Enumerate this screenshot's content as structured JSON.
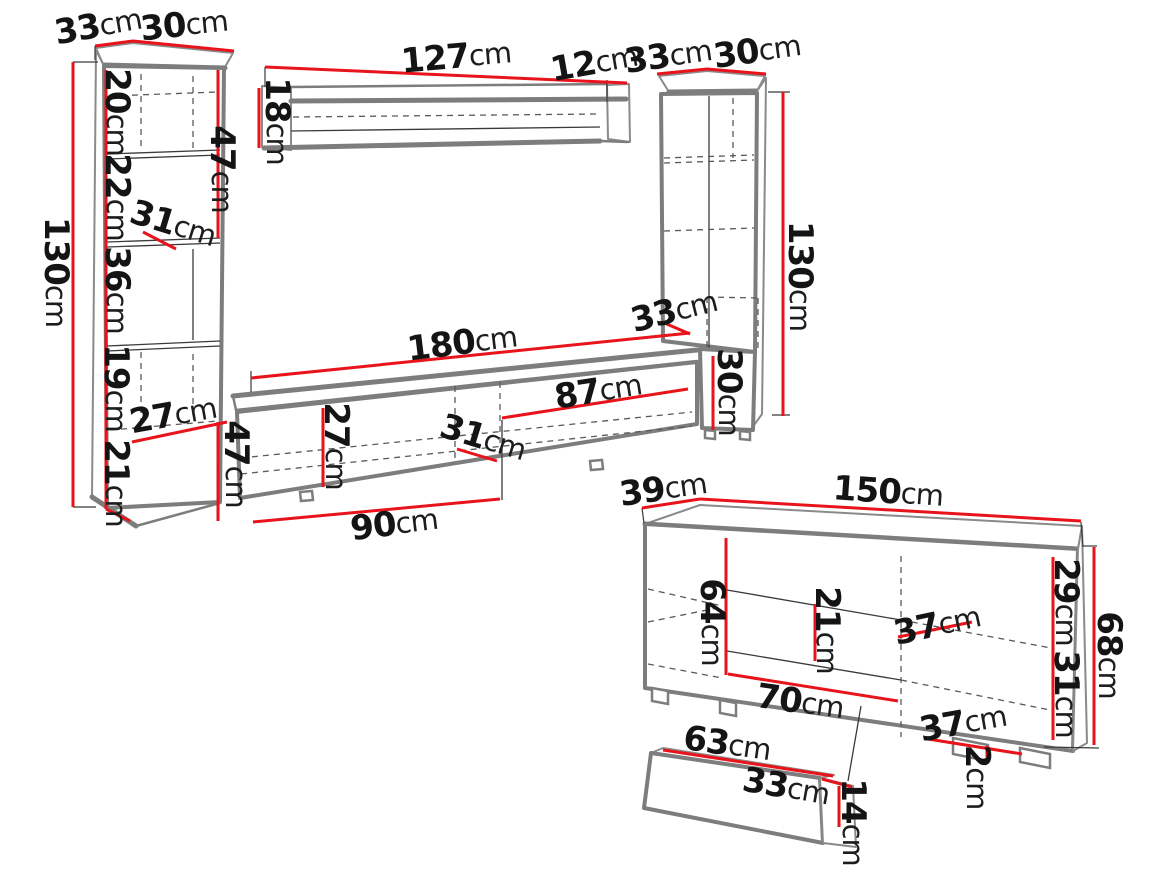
{
  "diagram": {
    "description": "Furniture wall-unit dimension drawing",
    "unit": "cm",
    "colors": {
      "background": "#ffffff",
      "outline": "#7d7d7d",
      "hidden_line": "#5a5a5a",
      "dimension_line": "#e8131b",
      "label_text": "#141414"
    }
  },
  "pieces": [
    {
      "id": "left-cabinet",
      "labels": [
        {
          "value": "33",
          "unit": "cm",
          "x": 98,
          "y": 26,
          "rot": -10
        },
        {
          "value": "30",
          "unit": "cm",
          "x": 184,
          "y": 25,
          "rot": -6
        },
        {
          "value": "130",
          "unit": "cm",
          "x": 56,
          "y": 272,
          "rot": 90
        },
        {
          "value": "20",
          "unit": "cm",
          "x": 117,
          "y": 112,
          "rot": 90
        },
        {
          "value": "22",
          "unit": "cm",
          "x": 117,
          "y": 197,
          "rot": 90
        },
        {
          "value": "31",
          "unit": "cm",
          "x": 173,
          "y": 224,
          "rot": 17
        },
        {
          "value": "36",
          "unit": "cm",
          "x": 117,
          "y": 290,
          "rot": 90
        },
        {
          "value": "19",
          "unit": "cm",
          "x": 116,
          "y": 388,
          "rot": 90
        },
        {
          "value": "27",
          "unit": "cm",
          "x": 173,
          "y": 415,
          "rot": -10
        },
        {
          "value": "21",
          "unit": "cm",
          "x": 116,
          "y": 483,
          "rot": 90
        },
        {
          "value": "47",
          "unit": "cm",
          "x": 222,
          "y": 169,
          "rot": 90
        }
      ]
    },
    {
      "id": "wall-shelf",
      "labels": [
        {
          "value": "127",
          "unit": "cm",
          "x": 456,
          "y": 57,
          "rot": -5
        },
        {
          "value": "12",
          "unit": "cm",
          "x": 594,
          "y": 63,
          "rot": -10
        },
        {
          "value": "18",
          "unit": "cm",
          "x": 277,
          "y": 121,
          "rot": 90
        }
      ]
    },
    {
      "id": "right-cabinet",
      "labels": [
        {
          "value": "33",
          "unit": "cm",
          "x": 668,
          "y": 56,
          "rot": -8
        },
        {
          "value": "30",
          "unit": "cm",
          "x": 757,
          "y": 51,
          "rot": -8
        },
        {
          "value": "130",
          "unit": "cm",
          "x": 800,
          "y": 276,
          "rot": 90
        },
        {
          "value": "33",
          "unit": "cm",
          "x": 674,
          "y": 311,
          "rot": -14
        },
        {
          "value": "30",
          "unit": "cm",
          "x": 729,
          "y": 392,
          "rot": 90
        }
      ]
    },
    {
      "id": "tv-stand",
      "labels": [
        {
          "value": "180",
          "unit": "cm",
          "x": 462,
          "y": 343,
          "rot": -7
        },
        {
          "value": "87",
          "unit": "cm",
          "x": 598,
          "y": 391,
          "rot": -9
        },
        {
          "value": "27",
          "unit": "cm",
          "x": 336,
          "y": 446,
          "rot": 90
        },
        {
          "value": "31",
          "unit": "cm",
          "x": 483,
          "y": 438,
          "rot": 17
        },
        {
          "value": "47",
          "unit": "cm",
          "x": 236,
          "y": 464,
          "rot": 90
        },
        {
          "value": "90",
          "unit": "cm",
          "x": 394,
          "y": 524,
          "rot": -7
        }
      ]
    },
    {
      "id": "sideboard",
      "labels": [
        {
          "value": "39",
          "unit": "cm",
          "x": 663,
          "y": 489,
          "rot": -8
        },
        {
          "value": "150",
          "unit": "cm",
          "x": 888,
          "y": 492,
          "rot": 4
        },
        {
          "value": "64",
          "unit": "cm",
          "x": 712,
          "y": 622,
          "rot": 90
        },
        {
          "value": "21",
          "unit": "cm",
          "x": 827,
          "y": 630,
          "rot": 90
        },
        {
          "value": "37",
          "unit": "cm",
          "x": 937,
          "y": 625,
          "rot": -12
        },
        {
          "value": "29",
          "unit": "cm",
          "x": 1066,
          "y": 602,
          "rot": 90
        },
        {
          "value": "31",
          "unit": "cm",
          "x": 1066,
          "y": 694,
          "rot": 90
        },
        {
          "value": "68",
          "unit": "cm",
          "x": 1109,
          "y": 655,
          "rot": 90
        },
        {
          "value": "70",
          "unit": "cm",
          "x": 800,
          "y": 702,
          "rot": 8
        },
        {
          "value": "37",
          "unit": "cm",
          "x": 963,
          "y": 723,
          "rot": -10
        },
        {
          "value": "2",
          "unit": "cm",
          "x": 977,
          "y": 777,
          "rot": 90
        }
      ]
    },
    {
      "id": "drawer",
      "labels": [
        {
          "value": "63",
          "unit": "cm",
          "x": 727,
          "y": 744,
          "rot": 8
        },
        {
          "value": "33",
          "unit": "cm",
          "x": 786,
          "y": 787,
          "rot": 10
        },
        {
          "value": "14",
          "unit": "cm",
          "x": 853,
          "y": 822,
          "rot": 90
        }
      ]
    }
  ]
}
